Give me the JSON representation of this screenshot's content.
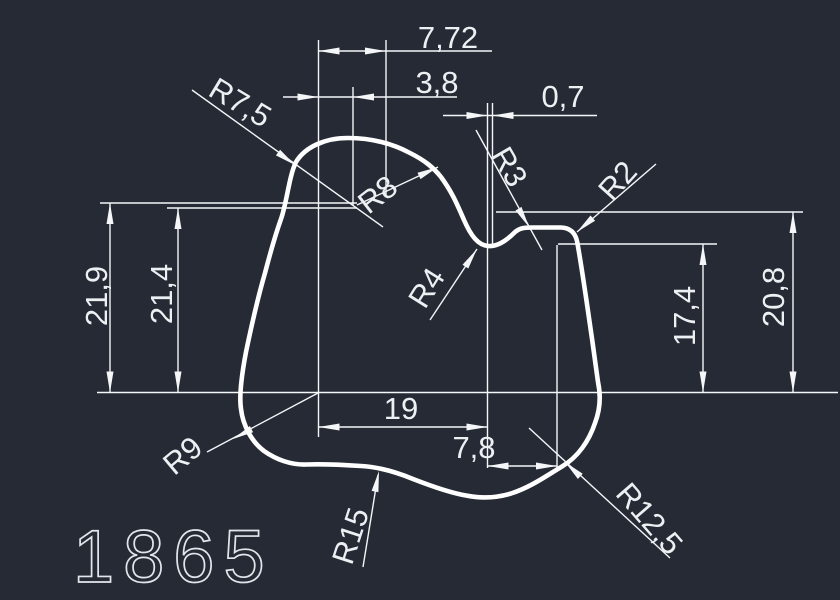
{
  "drawing": {
    "background_color": "#252a35",
    "line_color": "#ffffff",
    "part_number": "1865",
    "linear_dimensions": {
      "top_width_outer": "7,72",
      "top_width_inner": "3,8",
      "notch_offset": "0,7",
      "height_left_outer": "21,9",
      "height_left_inner": "21,4",
      "height_right_inner": "17,4",
      "height_right_outer": "20,8",
      "bottom_width": "19",
      "bottom_right_width": "7,8"
    },
    "radius_labels": {
      "top_left": "R7,5",
      "top_hump": "R8",
      "notch_upper": "R3",
      "shoulder_right": "R2",
      "notch_lower": "R4",
      "bottom_left": "R9",
      "bottom_center": "R15",
      "bottom_right": "R12,5"
    }
  }
}
